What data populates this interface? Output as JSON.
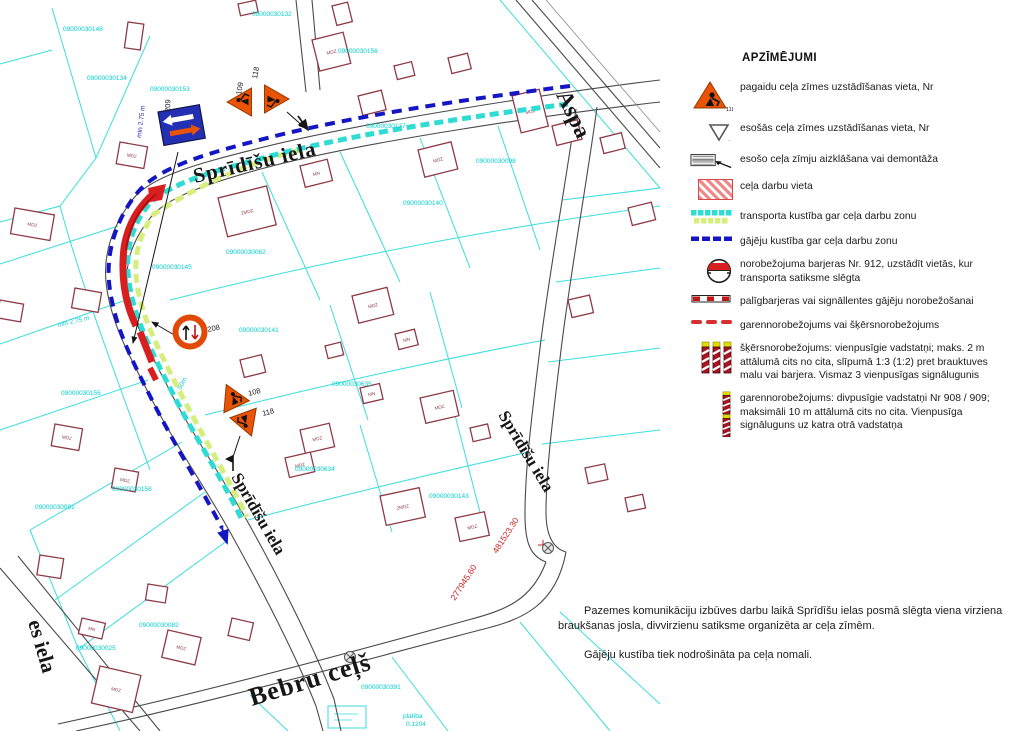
{
  "legend": {
    "title": "APZĪMĒJUMI",
    "items": [
      {
        "icon": "temp-sign",
        "nr": "118",
        "label": "pagaidu ceļa zīmes uzstādīšanas vieta, Nr"
      },
      {
        "icon": "existing-sign",
        "label": "esošās ceļa zīmes uzstādīšanas vieta, Nr"
      },
      {
        "icon": "sign-cover",
        "label": "esošo ceļa zīmju aizklāšana vai demontāža"
      },
      {
        "icon": "work-area",
        "label": "ceļa darbu vieta"
      },
      {
        "icon": "transport-flow",
        "label": "transporta kustība gar ceļa darbu zonu"
      },
      {
        "icon": "pedestrian-flow",
        "label": "gājēju kustība gar ceļa darbu zonu"
      },
      {
        "icon": "barrier-912",
        "label": "norobežojuma barjeras Nr. 912, uzstādīt vietās, kur transporta satiksme slēgta"
      },
      {
        "icon": "aux-barrier",
        "label": "palīgbarjeras vai signāllentes gājēju norobežošanai"
      },
      {
        "icon": "longitudinal-barrier",
        "label": "garennorobežojums vai šķērsnorobežojums"
      },
      {
        "icon": "posts-single",
        "label": "šķērsnorobežojums: vienpusīgie vadstatņi; maks. 2 m attālumā cits no cita, slīpumā 1:3 (1:2) pret brauktuves malu vai barjera. Vismaz 3 vienpusīgas signālugunis"
      },
      {
        "icon": "posts-double",
        "label": "garennorobežojums: divpusīgie vadstatņi Nr 908 / 909; maksimāli 10 m attālumā cits no cita. Vienpusīga signāluguns uz katra otrā vadstatņa"
      }
    ]
  },
  "notes": {
    "para1": "Pazemes komunikāciju izbūves darbu laikā Sprīdīšu ielas posmā slēgta viena virziena braukšanas josla, divvirzienu satiksme organizēta ar ceļa zīmēm.",
    "para2": "Gājēju kustība tiek nodrošināta pa ceļa nomali."
  },
  "map": {
    "streets": [
      {
        "name": "Sprīdīšu iela"
      },
      {
        "name": "Sprīdīšu iela"
      },
      {
        "name": "Sprīdīšu iela"
      },
      {
        "name": "Bebru ceļš"
      },
      {
        "name": "Aspa"
      },
      {
        "name": "es iela"
      }
    ],
    "signs": {
      "blue_sign_nr": "209",
      "tri_top_left_nr": "109",
      "tri_top_right_nr": "118",
      "round_sign_nr": "208",
      "tri_mid_upper_nr": "108",
      "tri_mid_lower_nr": "118"
    },
    "coords": [
      "277945.60",
      "481523.30"
    ],
    "annotations": [
      "min 2.75 m",
      "min 2.75 m",
      "50m"
    ],
    "area_note": {
      "line1": "platība",
      "line2": "0.1204"
    },
    "building_labels": [
      "MDZ",
      "2MDZ",
      "MN"
    ],
    "cadastral": [
      {
        "t": "09000030148",
        "x": 63,
        "y": 31
      },
      {
        "t": "09000030134",
        "x": 87,
        "y": 80
      },
      {
        "t": "09000030153",
        "x": 150,
        "y": 91
      },
      {
        "t": "09000030132",
        "x": 252,
        "y": 16
      },
      {
        "t": "09000030156",
        "x": 338,
        "y": 53
      },
      {
        "t": "09000030137",
        "x": 366,
        "y": 128
      },
      {
        "t": "09000030098",
        "x": 476,
        "y": 163
      },
      {
        "t": "09000030140",
        "x": 403,
        "y": 205
      },
      {
        "t": "09000030062",
        "x": 226,
        "y": 254
      },
      {
        "t": "09000030145",
        "x": 152,
        "y": 269
      },
      {
        "t": "09000030141",
        "x": 239,
        "y": 332
      },
      {
        "t": "09000030635",
        "x": 332,
        "y": 386
      },
      {
        "t": "09000030634",
        "x": 295,
        "y": 471
      },
      {
        "t": "09000030155",
        "x": 61,
        "y": 395
      },
      {
        "t": "09000030158",
        "x": 112,
        "y": 491
      },
      {
        "t": "09000030091",
        "x": 35,
        "y": 509
      },
      {
        "t": "09000030143",
        "x": 429,
        "y": 498
      },
      {
        "t": "09000030025",
        "x": 76,
        "y": 650
      },
      {
        "t": "09000030082",
        "x": 139,
        "y": 627
      },
      {
        "t": "09000030391",
        "x": 361,
        "y": 689
      }
    ]
  }
}
